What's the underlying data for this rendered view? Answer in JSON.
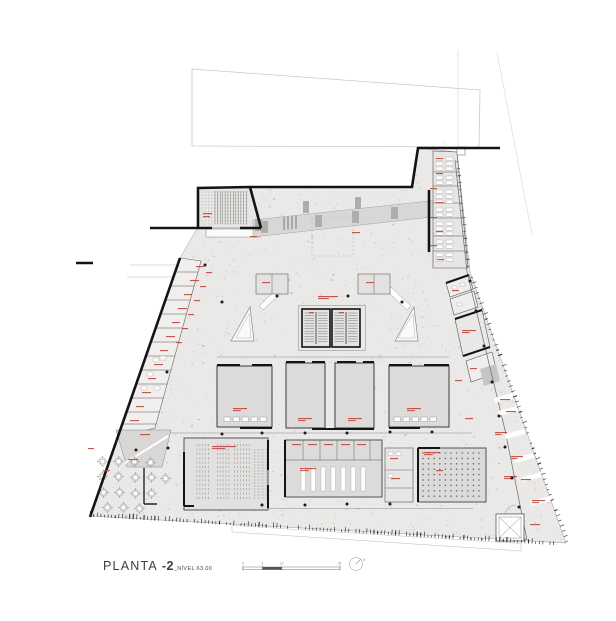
{
  "title": {
    "part1": "PLANTA ",
    "part2": "-2",
    "suffix": "_NÍVEL 63.00"
  },
  "scale_bar": {
    "tick_labels": [
      "0",
      "5",
      "10",
      "25"
    ],
    "tick_x": [
      243,
      262.4,
      281.8,
      339.5
    ]
  },
  "north": {
    "label": "N"
  },
  "colors": {
    "floor": "#eae9e7",
    "room": "#dcdbd9",
    "room_light": "#e7e6e4",
    "band": "#d8d7d5",
    "column": "#aeadab",
    "wall": "#141414",
    "thin": "#55524e",
    "red": "#c0453c",
    "speckle": "#b5b3b0",
    "speckle_dark": "#a09e9b",
    "seat": "#8f8e8c",
    "light": "#c9c8c6",
    "fixture": "#fdfdfc",
    "dark_block": "#c6c5c3"
  },
  "plan": {
    "red_labels": [
      [
        203,
        213,
        9
      ],
      [
        203,
        216,
        7
      ],
      [
        318,
        296,
        20
      ],
      [
        309,
        312,
        5
      ],
      [
        339,
        312,
        5
      ],
      [
        262,
        282,
        8
      ],
      [
        366,
        282,
        8
      ],
      [
        233,
        408,
        14
      ],
      [
        298,
        418,
        14
      ],
      [
        348,
        418,
        14
      ],
      [
        407,
        408,
        14
      ],
      [
        292,
        444,
        9
      ],
      [
        308,
        444,
        9
      ],
      [
        324,
        444,
        9
      ],
      [
        341,
        444,
        9
      ],
      [
        357,
        444,
        9
      ],
      [
        300,
        468,
        16
      ],
      [
        390,
        458,
        8
      ],
      [
        391,
        478,
        9
      ],
      [
        424,
        452,
        16
      ],
      [
        436,
        470,
        7
      ],
      [
        212,
        446,
        24
      ],
      [
        140,
        434,
        10
      ],
      [
        128,
        459,
        10
      ],
      [
        103,
        470,
        7
      ],
      [
        88,
        448,
        6
      ],
      [
        196,
        266,
        8
      ],
      [
        190,
        280,
        9
      ],
      [
        184,
        294,
        8
      ],
      [
        178,
        308,
        9
      ],
      [
        172,
        322,
        8
      ],
      [
        166,
        336,
        9
      ],
      [
        160,
        350,
        8
      ],
      [
        154,
        364,
        9
      ],
      [
        148,
        378,
        8
      ],
      [
        142,
        392,
        9
      ],
      [
        136,
        406,
        8
      ],
      [
        130,
        420,
        9
      ],
      [
        206,
        272,
        6
      ],
      [
        200,
        286,
        6
      ],
      [
        194,
        300,
        6
      ],
      [
        188,
        314,
        6
      ],
      [
        182,
        328,
        6
      ],
      [
        176,
        342,
        6
      ],
      [
        436,
        158,
        7
      ],
      [
        436,
        173,
        7
      ],
      [
        430,
        188,
        7
      ],
      [
        436,
        202,
        7
      ],
      [
        430,
        217,
        7
      ],
      [
        436,
        231,
        7
      ],
      [
        430,
        245,
        7
      ],
      [
        437,
        259,
        7
      ],
      [
        452,
        290,
        7
      ],
      [
        462,
        330,
        14
      ],
      [
        470,
        368,
        7
      ],
      [
        455,
        380,
        7
      ],
      [
        500,
        399,
        10
      ],
      [
        506,
        411,
        10
      ],
      [
        465,
        418,
        8
      ],
      [
        495,
        432,
        12
      ],
      [
        511,
        456,
        12
      ],
      [
        504,
        476,
        13
      ],
      [
        521,
        479,
        10
      ],
      [
        532,
        500,
        13
      ],
      [
        530,
        524,
        10
      ],
      [
        250,
        236,
        7
      ],
      [
        352,
        232,
        8
      ]
    ],
    "column_dots": [
      [
        222,
        302
      ],
      [
        402,
        302
      ],
      [
        222,
        434
      ],
      [
        262,
        433
      ],
      [
        305,
        433
      ],
      [
        347,
        433
      ],
      [
        390,
        432
      ],
      [
        432,
        432
      ],
      [
        262,
        505
      ],
      [
        305,
        505
      ],
      [
        347,
        504
      ],
      [
        390,
        504
      ],
      [
        470,
        281
      ],
      [
        476,
        311
      ],
      [
        484,
        346
      ],
      [
        492,
        382
      ],
      [
        499,
        416
      ],
      [
        505,
        447
      ],
      [
        512,
        478
      ],
      [
        519,
        507
      ],
      [
        205,
        265
      ],
      [
        167,
        372
      ],
      [
        136,
        450
      ],
      [
        168,
        448
      ],
      [
        348,
        296
      ],
      [
        277,
        296
      ]
    ],
    "cafe_tables": [
      [
        100,
        459
      ],
      [
        116,
        459
      ],
      [
        132,
        459
      ],
      [
        148,
        460
      ],
      [
        100,
        474
      ],
      [
        116,
        474
      ],
      [
        133,
        475
      ],
      [
        149,
        475
      ],
      [
        163,
        476
      ],
      [
        101,
        490
      ],
      [
        117,
        490
      ],
      [
        133,
        491
      ],
      [
        149,
        491
      ],
      [
        105,
        505
      ],
      [
        121,
        505
      ],
      [
        137,
        506
      ]
    ],
    "parking_dashes": [
      [
        504,
        398
      ],
      [
        508,
        411
      ],
      [
        515,
        434
      ],
      [
        524,
        458
      ],
      [
        532,
        477
      ],
      [
        541,
        501
      ]
    ],
    "band_columns": [
      [
        255,
        219
      ],
      [
        261,
        221
      ],
      [
        315,
        215
      ],
      [
        352,
        211
      ],
      [
        391,
        207
      ]
    ],
    "band_top_bars": [
      [
        303,
        201
      ],
      [
        355,
        197
      ]
    ],
    "left_room_divider_ys": [
      272,
      286,
      300,
      314,
      328,
      342,
      356,
      370,
      384,
      398,
      412,
      424
    ],
    "left_fixtures": [
      [
        153,
        358
      ],
      [
        147,
        372
      ],
      [
        160,
        356
      ],
      [
        141,
        386
      ],
      [
        154,
        386
      ]
    ],
    "right_col_divider_ys": [
      172,
      186,
      203,
      218,
      236,
      251
    ],
    "right_col_fixture_ys": [
      157,
      162,
      167,
      176,
      181,
      190,
      195,
      200,
      208,
      213,
      222,
      227,
      232,
      240,
      245,
      253,
      258
    ],
    "hall_fixture_rows": [
      {
        "xs_start": 224,
        "xs_end": 262,
        "step": 9,
        "y": 417
      },
      {
        "xs_start": 394,
        "xs_end": 432,
        "step": 9,
        "y": 417
      },
      {
        "xs_start": 290,
        "xs_end": 376,
        "step": 9.3,
        "y": 447
      }
    ],
    "auditorium": {
      "rows": 13,
      "row_y0": 444,
      "row_dy": 4.4,
      "x0": 197,
      "x1": 251,
      "dx": 2.9,
      "aisles": [
        [
          211.5,
          215
        ],
        [
          230.5,
          234
        ]
      ],
      "side_cols": [
        253.5,
        257.5,
        261.5,
        265.5
      ],
      "side_y0": 450,
      "side_y1": 498,
      "side_dy": 3
    },
    "storage_bars": {
      "count": 7,
      "x0": 301,
      "dx": 10,
      "y": 467,
      "w": 4.5,
      "h": 24
    },
    "dot_room": {
      "x0": 423,
      "y0": 453,
      "cols": 11,
      "rows": 9,
      "dx": 5.6,
      "dy": 5.4
    },
    "annex": {
      "dot_x0": 202,
      "dot_x1": 248,
      "dot_y0": 192,
      "dot_y1": 224,
      "stripe_x0": 215,
      "stripe_x1": 248
    },
    "cores": [
      [
        302,
        309
      ],
      [
        332,
        309
      ]
    ],
    "speckle": {
      "seed": 1234567,
      "count": 780,
      "dark": 110
    },
    "bottom_ticks": {
      "x0": 90,
      "y0": 516.5,
      "x1": 554,
      "y1": 545,
      "spacing": 3.6
    },
    "right_ticks": {
      "x0": 468,
      "y0": 273,
      "x1": 566,
      "y1": 543,
      "spacing": 5.5
    },
    "upper_right_ticks": {
      "x0": 456,
      "y0": 162,
      "x1": 467,
      "y1": 270,
      "spacing": 7
    }
  }
}
